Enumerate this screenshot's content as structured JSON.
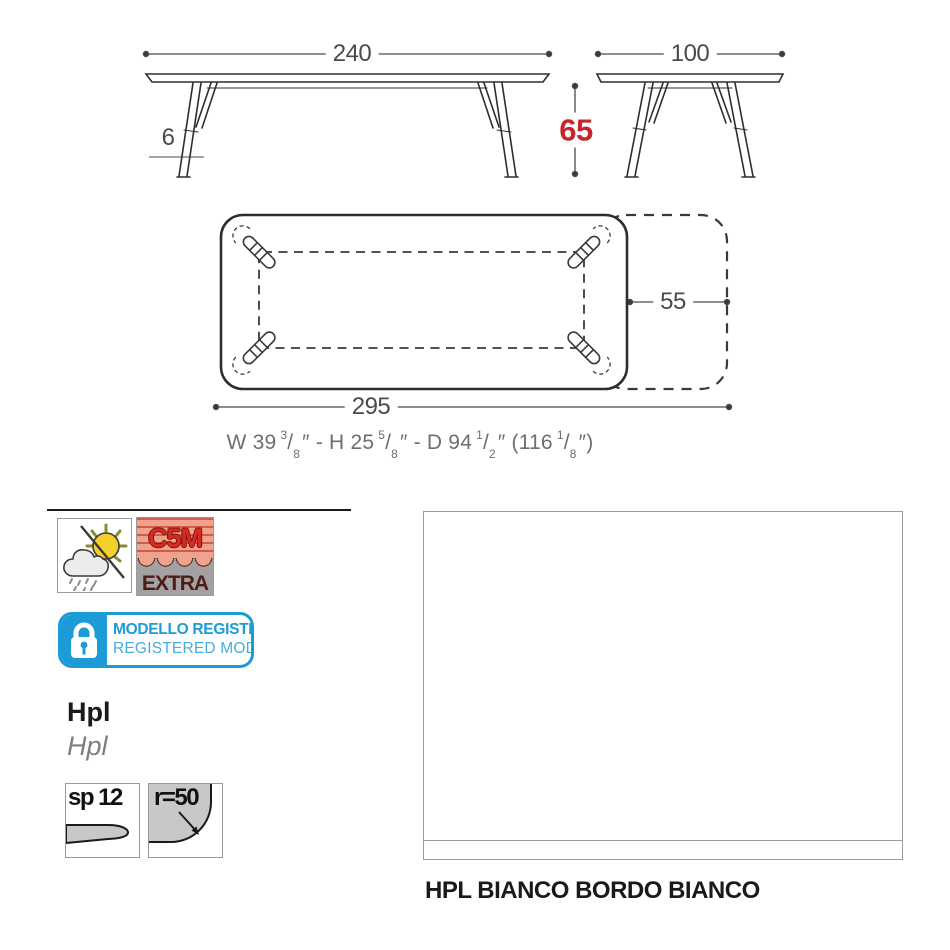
{
  "drawing": {
    "front_view": {
      "width": "240",
      "height": "65",
      "leg_thickness": "6"
    },
    "side_view": {
      "width": "100"
    },
    "plan_view": {
      "total_length": "295",
      "extension_depth": "55"
    }
  },
  "imperial_dimensions": {
    "parts": [
      {
        "text": "W 39"
      },
      {
        "num": "3",
        "den": "8"
      },
      {
        "text": "″ - H 25"
      },
      {
        "num": "5",
        "den": "8"
      },
      {
        "text": "″  - D 94"
      },
      {
        "num": "1",
        "den": "2"
      },
      {
        "text": "″ (116"
      },
      {
        "num": "1",
        "den": "8"
      },
      {
        "text": "″)"
      }
    ]
  },
  "certifications": {
    "c5m": {
      "code": "C5M",
      "grade": "EXTRA"
    },
    "registered_model": {
      "line1": "MODELLO REGISTRATO",
      "line2": "REGISTERED MODEL"
    }
  },
  "material": {
    "label_it": "Hpl",
    "label_en": "Hpl",
    "thickness_label": "sp 12",
    "corner_radius_label": "r=50"
  },
  "finish": {
    "caption": "HPL BIANCO BORDO BIANCO",
    "swatch_color": "#FFFFFF"
  },
  "colors": {
    "accent_red": "#C8242B",
    "badge_blue": "#1C9BD7",
    "c5m_salmon": "#EFA28C",
    "c5m_red": "#D62A22",
    "c5m_gray": "#A5A1A2",
    "c5m_maroon": "#4A1D15",
    "sun_yellow": "#F5D02B",
    "line_dark": "#3A3A39",
    "dim_gray": "#4A4A49"
  }
}
